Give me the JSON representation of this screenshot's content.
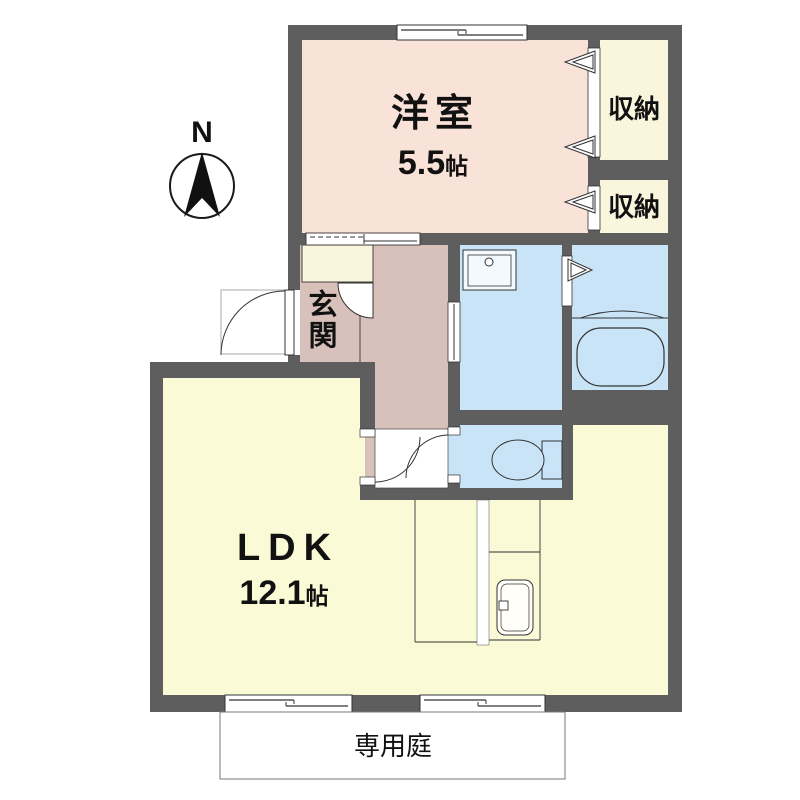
{
  "compass": {
    "north_label": "N"
  },
  "rooms": {
    "western_room": {
      "label": "洋室",
      "area_value": "5.5",
      "area_unit": "帖"
    },
    "storage_top": {
      "label": "収納"
    },
    "storage_bottom": {
      "label": "収納"
    },
    "entrance": {
      "label": "玄関"
    },
    "ldk": {
      "label": "LDK",
      "area_value": "12.1",
      "area_unit": "帖"
    },
    "private_garden": {
      "label": "専用庭"
    }
  },
  "colors": {
    "wall": "#5e5e5e",
    "western_room_fill": "#f9e2d8",
    "hall_fill": "#d8c1bb",
    "closet_fill": "#faf6dd",
    "wet_area_fill": "#c9e4f7",
    "ldk_fill": "#fafad6",
    "garden_fill": "#ffffff",
    "fixture_stroke": "#333333"
  }
}
